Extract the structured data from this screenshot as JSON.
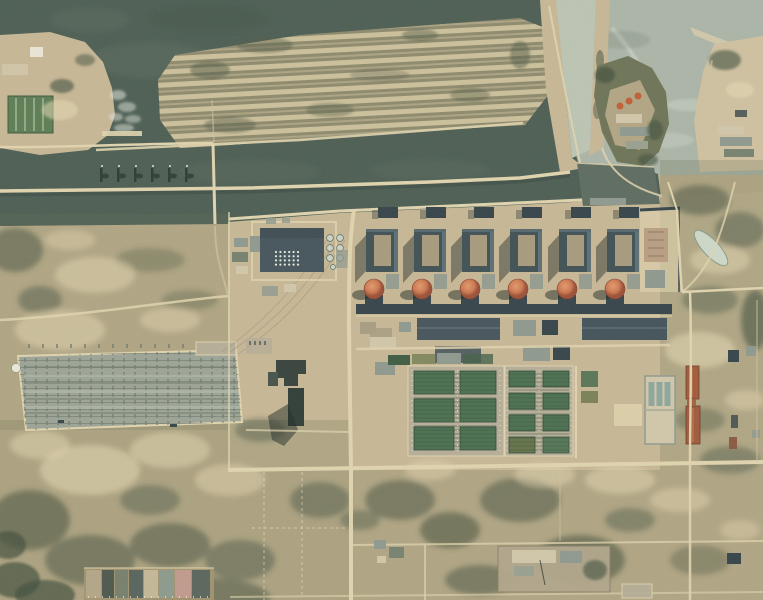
{
  "meta": {
    "description": "Aerial satellite photograph of a large riverside nuclear power plant: six reactor units with orange containment domes along a dark cooling channel, a striped spoil island, an intake canal and pale bay at top right, a large open-air switchyard at left, green spray cooling pond grids at center, and sandy scrubland with roads to the south.",
    "width": 763,
    "height": 600
  },
  "scene": {
    "features": {
      "reactor_units": 6,
      "turbine_halls": 6,
      "reactor_domes": 6,
      "vent_buildings": 6,
      "spray_pond_cells_left_group": 6,
      "spray_pond_cells_right_group": 8,
      "settling_basin_cells": 8,
      "orange_roofed_buildings": 3,
      "channel_groynes": 6
    },
    "colors": {
      "sand": "#c2b28f",
      "sandLight": "#e6d8b2",
      "sandDark": "#a3946f",
      "platform": "#c7b795",
      "waterDark": "#4d5e53",
      "waterMottle": "#627465",
      "waterPale": "#abb5a7",
      "waterCanal": "#bcc4b3",
      "intakeDark": "#5e6c60",
      "island": "#8e8a6d",
      "islandStripe": "#dbcca5",
      "islandDark": "#535c47",
      "scrubGreen": "#6b7355",
      "treeDark": "#414f3d",
      "road": "#e0d4ae",
      "roadFaint": "#cfc2a0",
      "hall": "#405154",
      "hallRoof": "#a89a7d",
      "hallEdge": "#5f7278",
      "blockDark": "#364449",
      "dome": "#cd7950",
      "domeHi": "#e29a6e",
      "domeLo": "#9c5036",
      "bldDark": "#46555c",
      "bldGrey": "#8f998e",
      "bldLight": "#d1c7aa",
      "white": "#eeeadb",
      "concrete": "#b6ae97",
      "pond": "#4c7050",
      "pondLine": "#36553d",
      "pondOlive": "#667349",
      "switchyard": "#9ca496",
      "switchLine": "#6f796b",
      "rust": "#a15a3b",
      "rustDark": "#6e3a24",
      "shadow": "#202a26",
      "greenPond": "#5d7d54",
      "orangeRoof": "#c05f36",
      "foam": "#e2e8dc"
    }
  }
}
